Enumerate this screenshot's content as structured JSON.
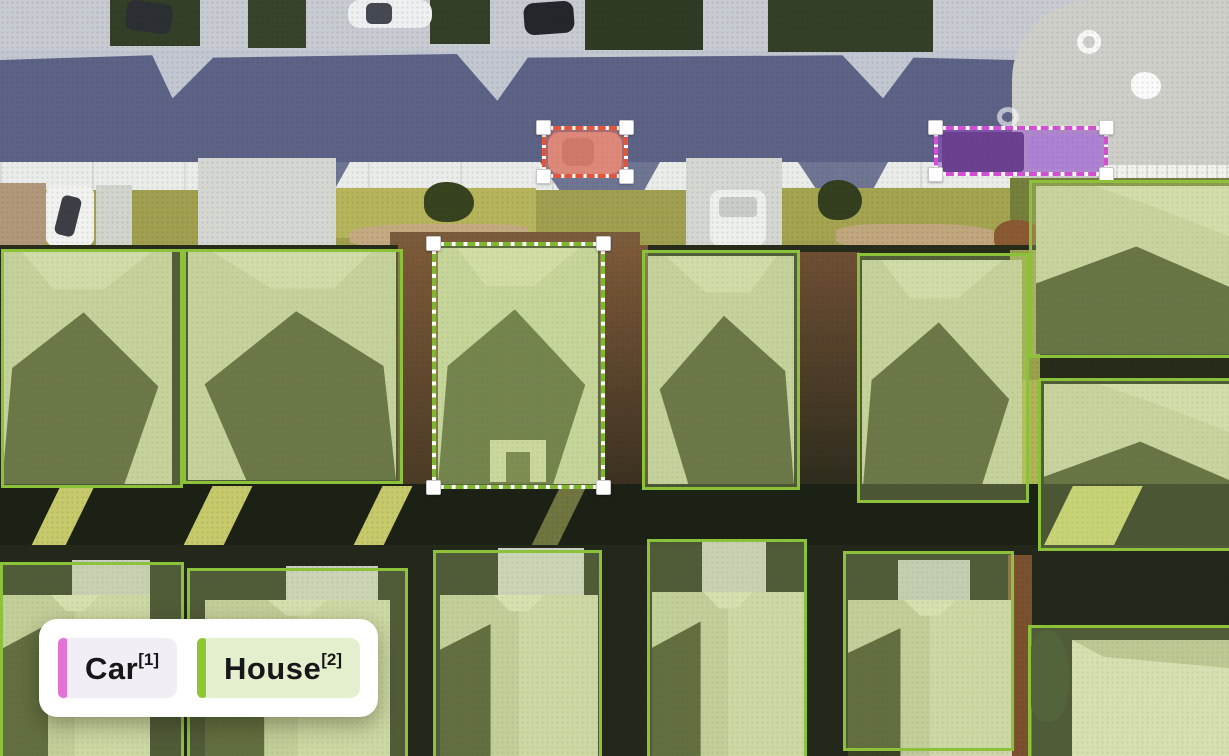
{
  "legend": {
    "items": [
      {
        "label": "Car",
        "sup": "[1]",
        "bar_color": "#e373d2",
        "bg": "#f2eef5"
      },
      {
        "label": "House",
        "sup": "[2]",
        "bar_color": "#8ec531",
        "bg": "#e4f0cd"
      }
    ]
  },
  "annotation_colors": {
    "house_solid": "#8cc23a",
    "house_selected": "#7fb82e",
    "car_red": "#e2543c",
    "car_purple": "#d14fd0"
  },
  "annotations": [
    {
      "name": "car-box-red",
      "label": "Car",
      "style": "dashed",
      "handles": true,
      "color": "#e2543c",
      "fill": "rgba(235,115,95,0.50)",
      "x": 542,
      "y": 126,
      "w": 86,
      "h": 52
    },
    {
      "name": "car-box-purple",
      "label": "Car",
      "style": "dashed",
      "handles": true,
      "color": "#d14fd0",
      "fill": "rgba(148,78,198,0.55)",
      "x": 934,
      "y": 126,
      "w": 174,
      "h": 50
    },
    {
      "name": "house-box-selected",
      "label": "House",
      "style": "dashed",
      "handles": true,
      "color": "#7fb82e",
      "fill": "rgba(198,228,134,0.35)",
      "x": 432,
      "y": 242,
      "w": 173,
      "h": 247
    },
    {
      "name": "house-box-1",
      "label": "House",
      "style": "solid",
      "handles": false,
      "color": "#8cc23a",
      "fill": "rgba(196,227,138,0.28)",
      "x": 1,
      "y": 249,
      "w": 182,
      "h": 239
    },
    {
      "name": "house-box-2",
      "label": "House",
      "style": "solid",
      "handles": false,
      "color": "#8cc23a",
      "fill": "rgba(196,227,138,0.28)",
      "x": 183,
      "y": 249,
      "w": 220,
      "h": 235
    },
    {
      "name": "house-box-3",
      "label": "House",
      "style": "solid",
      "handles": false,
      "color": "#8cc23a",
      "fill": "rgba(196,227,138,0.28)",
      "x": 642,
      "y": 250,
      "w": 158,
      "h": 240
    },
    {
      "name": "house-box-4",
      "label": "House",
      "style": "solid",
      "handles": false,
      "color": "#8cc23a",
      "fill": "rgba(196,227,138,0.28)",
      "x": 857,
      "y": 253,
      "w": 172,
      "h": 250
    },
    {
      "name": "house-box-5",
      "label": "House",
      "style": "solid",
      "handles": false,
      "color": "#8cc23a",
      "fill": "rgba(196,227,138,0.28)",
      "x": 1029,
      "y": 180,
      "w": 205,
      "h": 178
    },
    {
      "name": "house-box-6",
      "label": "House",
      "style": "solid",
      "handles": false,
      "color": "#8cc23a",
      "fill": "rgba(196,227,138,0.28)",
      "x": 1038,
      "y": 378,
      "w": 196,
      "h": 173
    },
    {
      "name": "house-box-7",
      "label": "House",
      "style": "solid",
      "handles": false,
      "color": "#8cc23a",
      "fill": "rgba(196,227,138,0.28)",
      "x": 0,
      "y": 562,
      "w": 184,
      "h": 199
    },
    {
      "name": "house-box-8",
      "label": "House",
      "style": "solid",
      "handles": false,
      "color": "#8cc23a",
      "fill": "rgba(196,227,138,0.28)",
      "x": 187,
      "y": 568,
      "w": 221,
      "h": 193
    },
    {
      "name": "house-box-9",
      "label": "House",
      "style": "solid",
      "handles": false,
      "color": "#8cc23a",
      "fill": "rgba(196,227,138,0.28)",
      "x": 433,
      "y": 550,
      "w": 169,
      "h": 211
    },
    {
      "name": "house-box-10",
      "label": "House",
      "style": "solid",
      "handles": false,
      "color": "#8cc23a",
      "fill": "rgba(196,227,138,0.28)",
      "x": 647,
      "y": 539,
      "w": 160,
      "h": 222
    },
    {
      "name": "house-box-11",
      "label": "House",
      "style": "solid",
      "handles": false,
      "color": "#8cc23a",
      "fill": "rgba(196,227,138,0.28)",
      "x": 843,
      "y": 551,
      "w": 171,
      "h": 200
    },
    {
      "name": "house-box-12",
      "label": "House",
      "style": "solid",
      "handles": false,
      "color": "#8cc23a",
      "fill": "rgba(196,227,138,0.28)",
      "x": 1028,
      "y": 625,
      "w": 206,
      "h": 136
    }
  ]
}
